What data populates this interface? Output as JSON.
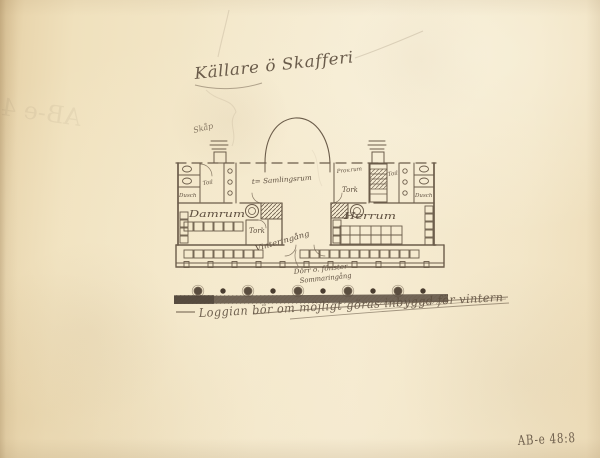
{
  "page": {
    "paper_color": "#f3e6c8",
    "pencil_color": "#5f5040",
    "ground_strip_color": "#51453a",
    "archive_ink_color": "#7c6142"
  },
  "handwriting": {
    "title": "Källare ö Skafferi",
    "cupboard_note": "Skåp",
    "bottom_note": "Loggian bör om möjligt göras inbyggd för vintern",
    "archive_ref": "AB-e 48:8",
    "bleed_through_ghost": "AB-e 48"
  },
  "plan_labels": {
    "hall": "t= Samlingsrum",
    "left_wing_room": "Damrum",
    "left_toilet": "Toil",
    "left_shower": "Dusch",
    "left_drying": "Tork",
    "right_wing_room": "Herrum",
    "right_pantry": "Prov.rum",
    "right_drying": "Tork",
    "right_toilet": "Toil",
    "right_shower": "Dusch",
    "winter_entrance": "Vinteringång",
    "summer_entrance_line1": "Dörr o. fönster",
    "summer_entrance_line2": "Sommaringång"
  }
}
